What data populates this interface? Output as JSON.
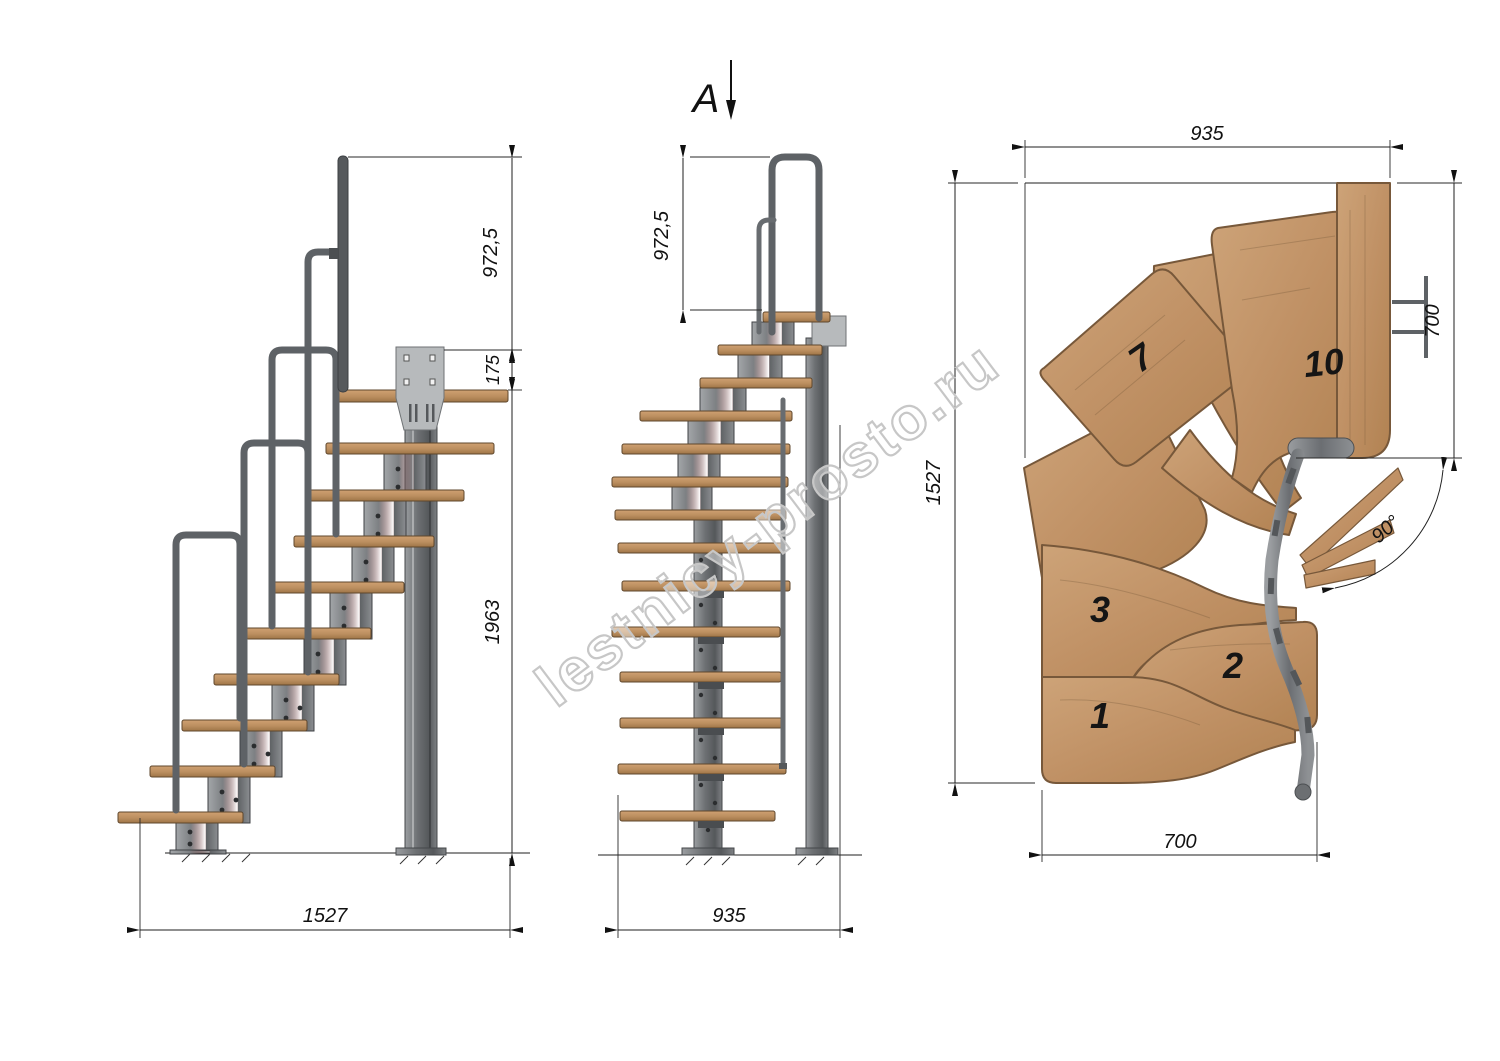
{
  "watermark": {
    "text": "lestnicy-prosto.ru"
  },
  "views": {
    "side": {
      "dim_rail_height": "972,5",
      "dim_plate_offset": "175",
      "dim_column_height": "1963",
      "dim_total_run": "1527"
    },
    "front": {
      "section_label": "A",
      "dim_rail_height": "972,5",
      "dim_width": "935"
    },
    "plan": {
      "dim_top_width": "935",
      "dim_landing_depth": "700",
      "dim_total_length": "1527",
      "dim_flight_width": "700",
      "dim_turn_angle": "90°",
      "tread_numbers": {
        "t1": "1",
        "t2": "2",
        "t3": "3",
        "t7": "7",
        "t10": "10"
      }
    }
  },
  "colors": {
    "wood": "#c49a6d",
    "wood_dark": "#7a5b3c",
    "metal": "#8d9194",
    "metal_dark": "#55585b",
    "line": "#1f1f1f",
    "watermark_gray": "#c7c7c7"
  }
}
